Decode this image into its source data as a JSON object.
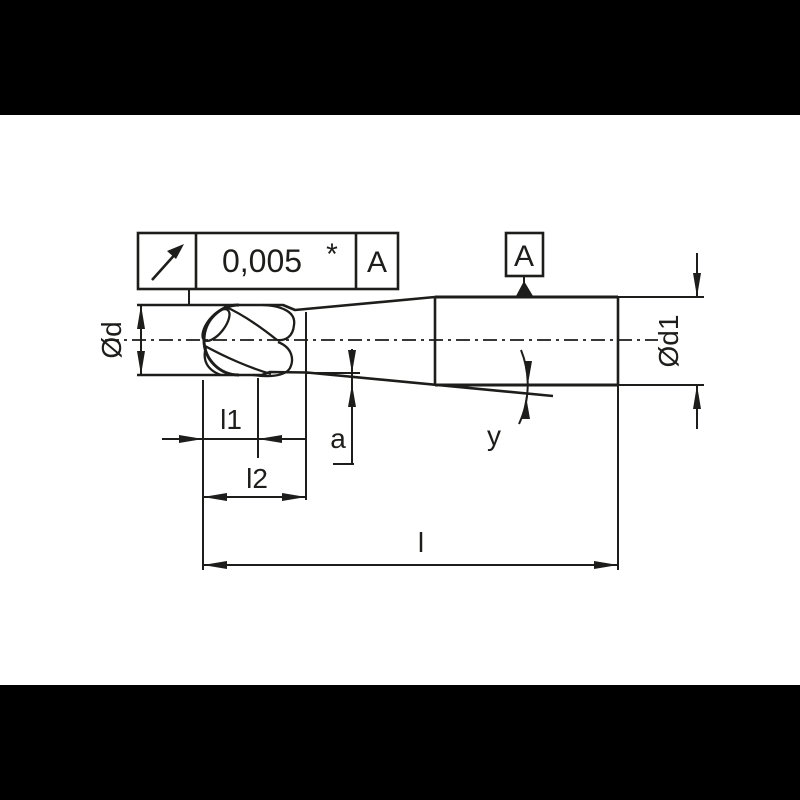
{
  "drawing": {
    "tolerance_frame": {
      "symbol_icon": "runout-arrow",
      "value": "0,005",
      "modifier": "*",
      "datum_ref": "A"
    },
    "datum": {
      "letter": "A"
    },
    "dim_labels": {
      "d": "Ød",
      "d1": "Ød1",
      "l1": "l1",
      "l2": "l2",
      "a": "a",
      "angle": "y",
      "l": "l"
    },
    "colors": {
      "ink": "#1d1d1b",
      "background": "#ffffff",
      "band": "#000000"
    }
  }
}
